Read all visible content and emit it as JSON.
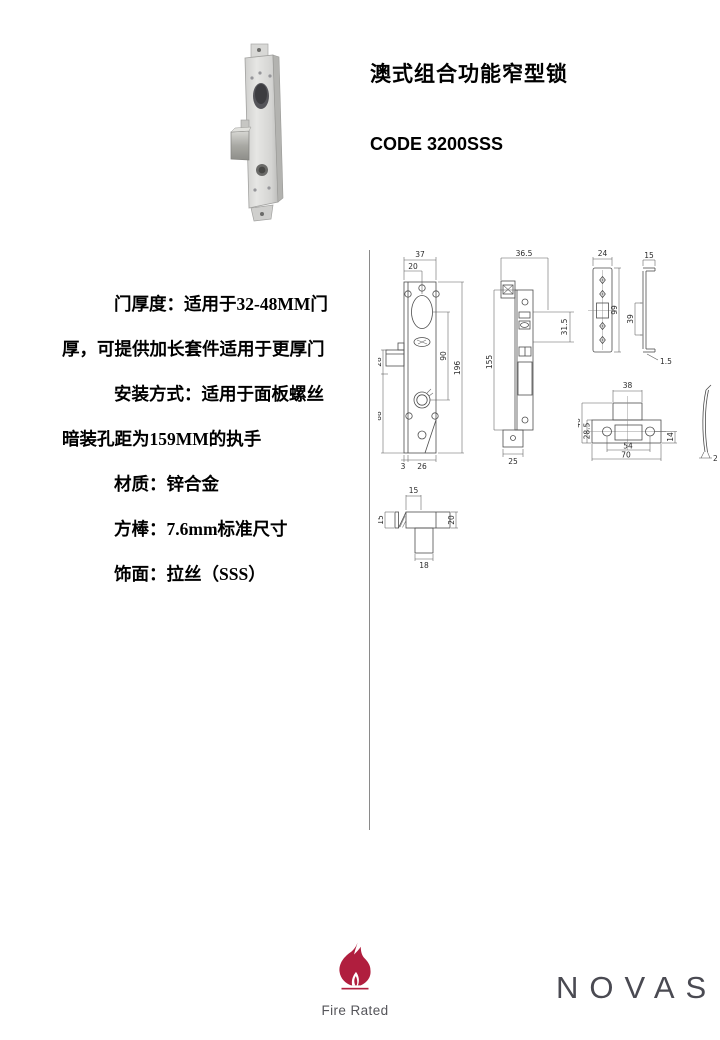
{
  "header": {
    "title": "澳式组合功能窄型锁",
    "code": "CODE 3200SSS"
  },
  "specs": {
    "door": {
      "label": "门厚度：",
      "line1": "适用于32-48MM门",
      "line2": "厚，可提供加长套件适用于更厚门"
    },
    "install": {
      "label": "安装方式：",
      "line1": "适用于面板螺丝",
      "line2": "暗装孔距为159MM的执手"
    },
    "material": {
      "label": "材质：",
      "value": "锌合金"
    },
    "spindle": {
      "label": "方棒：",
      "value": "7.6mm标准尺寸"
    },
    "finish": {
      "label": "饰面：",
      "value": "拉丝（SSS）"
    }
  },
  "drawings": {
    "lock_front": {
      "dim_37": "37",
      "dim_20": "20",
      "dim_28": "28",
      "dim_88": "88",
      "dim_90": "90",
      "dim_196": "196",
      "dim_3": "3",
      "dim_26": "26"
    },
    "faceplate": {
      "dim_36_5": "36.5",
      "dim_31_5": "31.5",
      "dim_155": "155",
      "dim_25": "25"
    },
    "strike_flat": {
      "dim_24": "24",
      "dim_99": "99",
      "dim_15": "15",
      "dim_39": "39",
      "dim_1_5": "1.5"
    },
    "strike_box": {
      "dim_38": "38",
      "dim_46": "46",
      "dim_28_5": "28.5",
      "dim_54": "54",
      "dim_70": "70",
      "dim_14": "14",
      "dim_2": "2"
    },
    "latch": {
      "dim_15_top": "15",
      "dim_15_left": "15",
      "dim_20": "20",
      "dim_18": "18"
    }
  },
  "footer": {
    "fire_rated_label": "Fire Rated",
    "brand": "NOVAS"
  },
  "colors": {
    "flame": "#b01e3e",
    "brand_text": "#4a4a52"
  }
}
